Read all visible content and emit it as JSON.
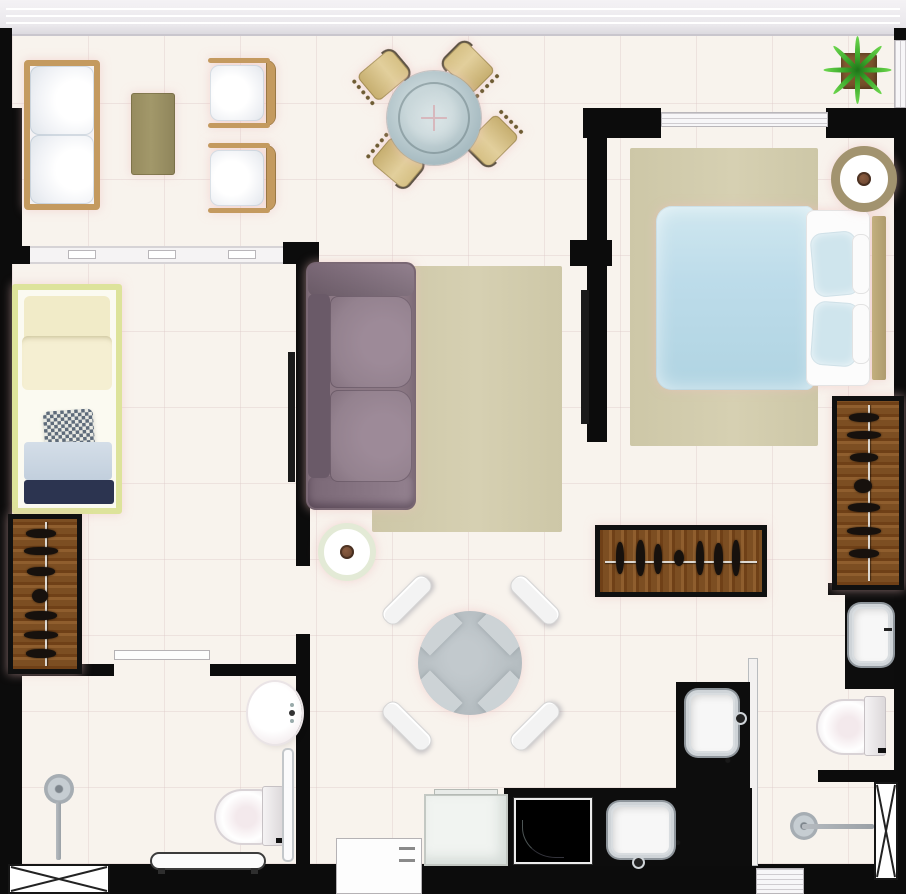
{
  "title": "apartment-floor-plan-top-view",
  "canvas": {
    "width_px": 906,
    "height_px": 894
  },
  "palette": {
    "wall": "#0c0c0c",
    "floor": "#f8f3ed",
    "window_band": "#eae8ec",
    "wood_frame": "#c49a5f",
    "wood_table": "#a2986a",
    "wardrobe_wood": "#7c4e22",
    "rattan": "#d5c084",
    "glass_outer": "#9fb4bb",
    "glass_inner": "#c9d7da",
    "plant_green": "#3aa82a",
    "plant_pot": "#6f4a26",
    "rug": "#cdc7a7",
    "duvet": "#bddcea",
    "pillow_blue": "#cfe5ed",
    "headboard": "#ae9b6d",
    "bed2_frame": "#dde39b",
    "bed2_pillow": "#f1ebc8",
    "navy": "#2c3450",
    "blanket_blue": "#c2cfdd",
    "sofa_purple": "#8b7884",
    "sofa_purple_dark": "#6a5a68",
    "ring_tan": "#a2936f",
    "ring_green": "#e3ead6",
    "cup": "#6b4630",
    "btable": "#b4bcc0",
    "chair_white": "#f3f3f3",
    "counter": "#0d0d0d",
    "chrome": "#cfd4d8",
    "fixture": "#fdfdfd"
  },
  "rooms": [
    {
      "id": "living-room",
      "furniture": [
        "wood-frame-sofa",
        "coffee-table",
        "armchair",
        "armchair"
      ]
    },
    {
      "id": "dining-area",
      "furniture": [
        "round-glass-table",
        "rattan-chair",
        "rattan-chair",
        "rattan-chair",
        "rattan-chair",
        "potted-plant"
      ]
    },
    {
      "id": "bedroom-1",
      "furniture": [
        "double-bed",
        "area-rug",
        "round-side-table",
        "open-wardrobe-horizontal",
        "open-wardrobe-vertical"
      ]
    },
    {
      "id": "bedroom-2",
      "furniture": [
        "single-bed",
        "open-wardrobe"
      ]
    },
    {
      "id": "tv-lounge",
      "furniture": [
        "purple-sofa",
        "area-rug",
        "round-side-table"
      ]
    },
    {
      "id": "breakfast-area",
      "furniture": [
        "round-table",
        "white-chair",
        "white-chair",
        "white-chair",
        "white-chair"
      ]
    },
    {
      "id": "bathroom-1",
      "furniture": [
        "shower",
        "toilet",
        "oval-sink",
        "glass-screen",
        "bench",
        "louver-vent"
      ]
    },
    {
      "id": "kitchen",
      "furniture": [
        "refrigerator",
        "cooktop",
        "l-shaped-counter",
        "kitchen-sink",
        "prep-sink"
      ]
    },
    {
      "id": "bathroom-2",
      "furniture": [
        "vanity-sink",
        "toilet",
        "shower",
        "duct-shaft"
      ]
    }
  ]
}
